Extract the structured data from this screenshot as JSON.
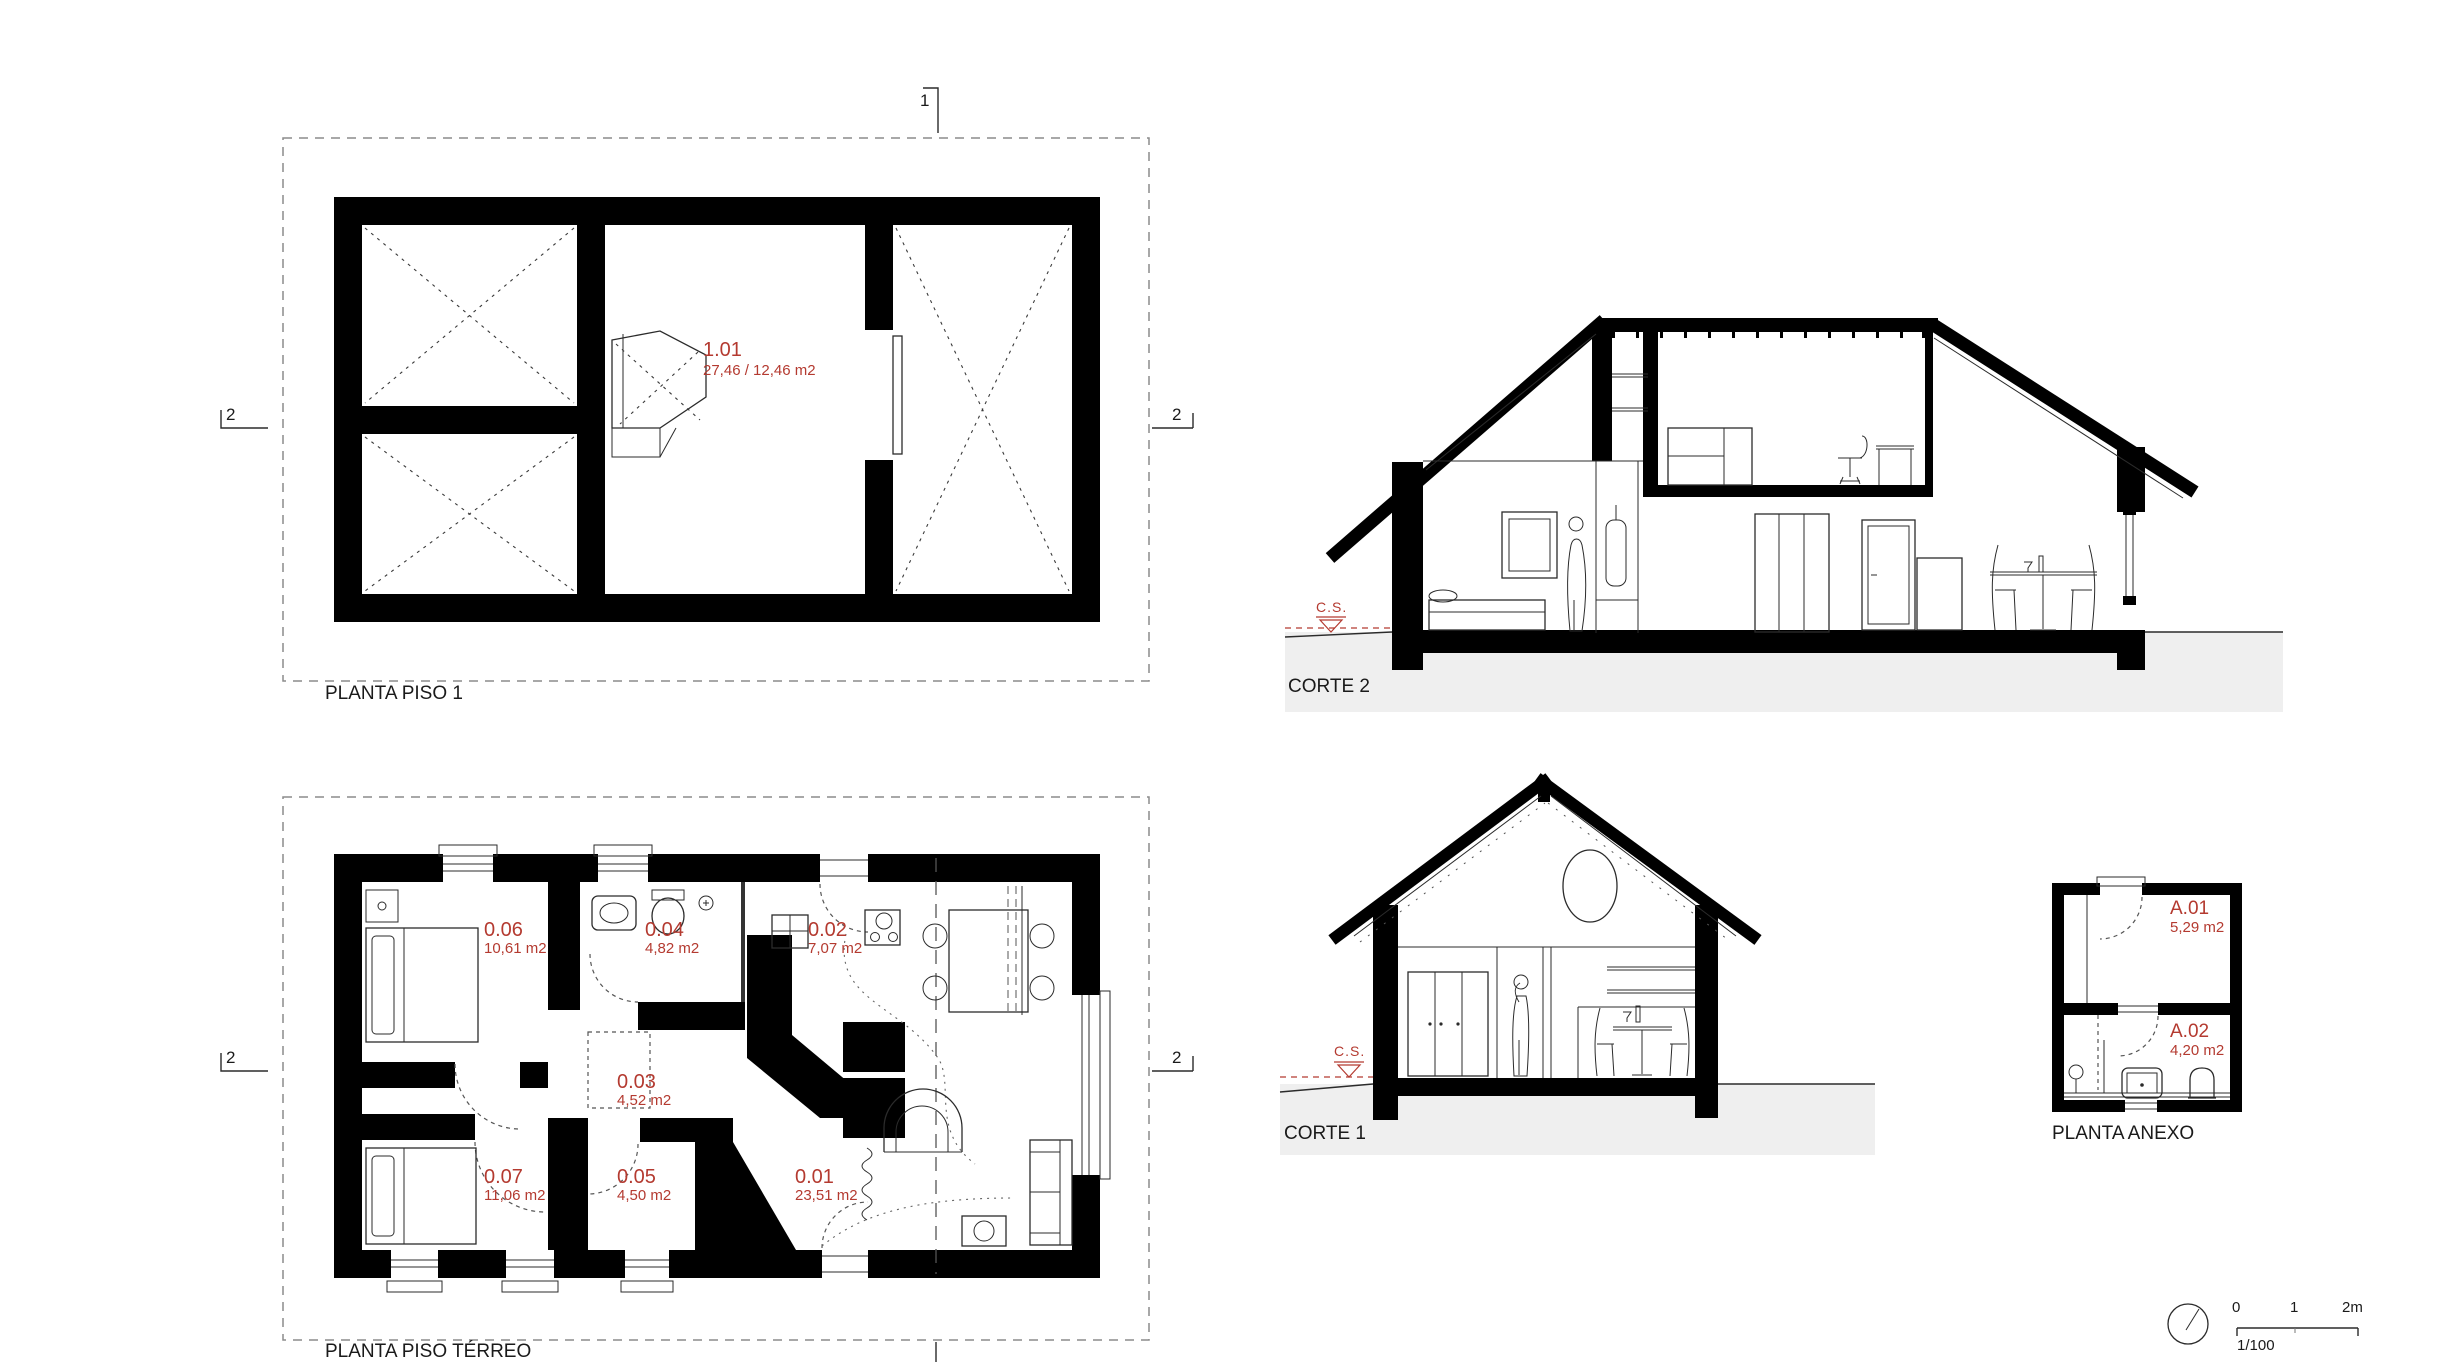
{
  "colors": {
    "accent_red": "#b43a30",
    "ink": "#1a1a1a",
    "ground_gray": "#efefef"
  },
  "drawings": {
    "planta_piso_1": {
      "title": "PLANTA PISO 1",
      "room": {
        "id": "1.01",
        "area": "27,46 / 12,46 m2"
      },
      "markers": {
        "top": "1",
        "left": "2",
        "right": "2"
      }
    },
    "corte_2": {
      "title": "CORTE 2",
      "level_marker": "C.S."
    },
    "planta_piso_terreo": {
      "title": "PLANTA PISO TÉRREO",
      "markers": {
        "left": "2",
        "right": "2"
      },
      "rooms": [
        {
          "id": "0.06",
          "area": "10,61 m2"
        },
        {
          "id": "0.04",
          "area": "4,82 m2"
        },
        {
          "id": "0.02",
          "area": "7,07 m2"
        },
        {
          "id": "0.03",
          "area": "4,52 m2"
        },
        {
          "id": "0.07",
          "area": "11,06 m2"
        },
        {
          "id": "0.05",
          "area": "4,50 m2"
        },
        {
          "id": "0.01",
          "area": "23,51 m2"
        }
      ]
    },
    "corte_1": {
      "title": "CORTE 1",
      "level_marker": "C.S."
    },
    "planta_anexo": {
      "title": "PLANTA ANEXO",
      "rooms": [
        {
          "id": "A.01",
          "area": "5,29 m2"
        },
        {
          "id": "A.02",
          "area": "4,20 m2"
        }
      ]
    },
    "scale_bar": {
      "tick_0": "0",
      "tick_1": "1",
      "tick_2": "2m",
      "ratio": "1/100"
    }
  }
}
